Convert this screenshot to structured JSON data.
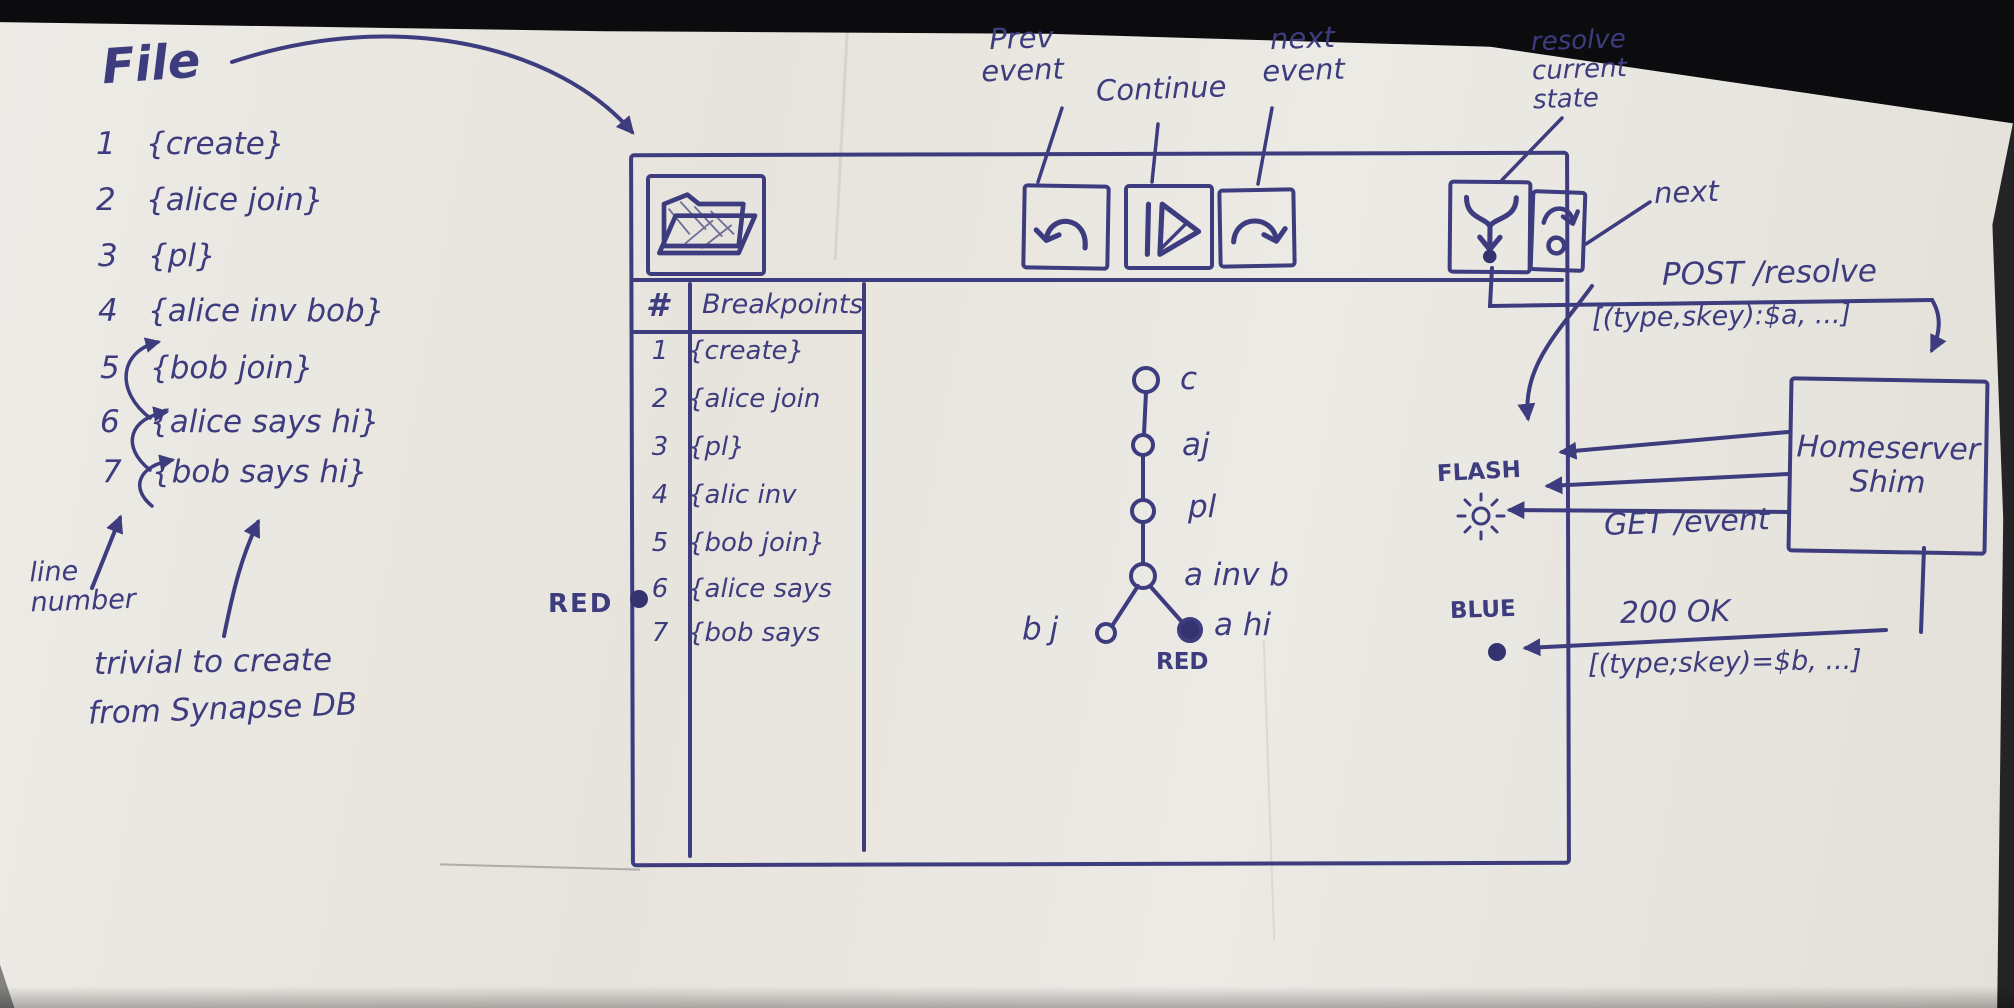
{
  "ink": "#3d3c7e",
  "paper_color": "#e9e6e1",
  "file_panel": {
    "title": "File",
    "lines": [
      {
        "num": "1",
        "text": "{create}"
      },
      {
        "num": "2",
        "text": "{alice join}"
      },
      {
        "num": "3",
        "text": "{pl}"
      },
      {
        "num": "4",
        "text": "{alice inv bob}"
      },
      {
        "num": "5",
        "text": "{bob join}"
      },
      {
        "num": "6",
        "text": "{alice says hi}"
      },
      {
        "num": "7",
        "text": "{bob says hi}"
      }
    ],
    "line_number_note": "line number",
    "trivial_note_line1": "trivial to create",
    "trivial_note_line2": "from Synapse DB"
  },
  "toolbar": {
    "prev_event_label": "Prev event",
    "continue_label": "Continue",
    "next_event_label": "next event",
    "resolve_label": "resolve current state",
    "next_label": "next",
    "icons": [
      "open-file-folder",
      "undo-prev-event",
      "play-continue",
      "redo-next-event",
      "merge-resolve-state",
      "step-next"
    ]
  },
  "breakpoints": {
    "col_num_header": "#",
    "col_bp_header": "Breakpoints",
    "rows": [
      {
        "num": "1",
        "text": "{create}"
      },
      {
        "num": "2",
        "text": "{alice join"
      },
      {
        "num": "3",
        "text": "{pl}"
      },
      {
        "num": "4",
        "text": "{alic inv"
      },
      {
        "num": "5",
        "text": "{bob join}"
      },
      {
        "num": "6",
        "text": "{alice says"
      },
      {
        "num": "7",
        "text": "{bob says"
      }
    ],
    "red_marker_label": "RED",
    "marked_row": "6"
  },
  "graph": {
    "node_c": "c",
    "node_aj": "aj",
    "node_pl": "pl",
    "node_ainvb": "a inv b",
    "node_bj": "bj",
    "node_ahi": "a hi",
    "red_label": "RED"
  },
  "flows": {
    "post_title": "POST /resolve",
    "post_payload": "[(type,skey):$a, ...]",
    "get_label": "GET /event",
    "ok_title": "200 OK",
    "ok_payload": "[(type;skey)=$b, ...]",
    "flash_label": "FLASH",
    "blue_label": "BLUE"
  },
  "homeserver": {
    "name_line1": "Homeserver",
    "name_line2": "Shim"
  }
}
